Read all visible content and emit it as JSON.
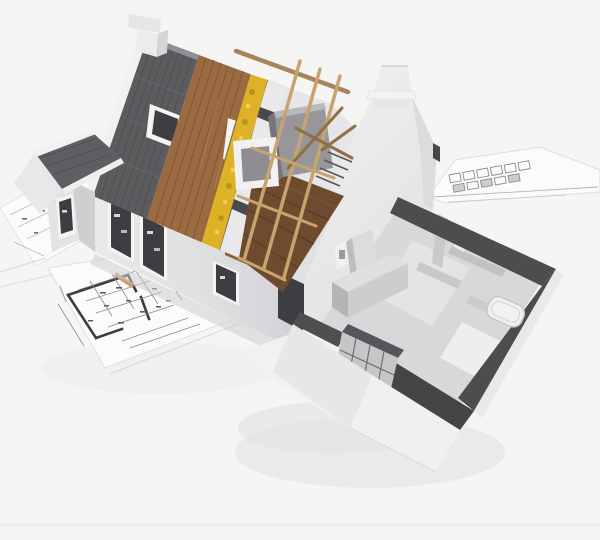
{
  "image_alt": "3D architectural rendering of a cutaway house model under construction, showing roof layers (shingles, wood sheathing, yellow insulation, white panels, exposed rafters), a white stepped gable wall, and a cutaway ground floor with rooms, sitting on architectural blueprint sheets",
  "palette": {
    "background": "#f5f5f4",
    "background_edge": "#ebebea",
    "shadow_soft": "#e9e9ea",
    "paper": "#fbfbfc",
    "paper_edge": "#dcdcdf",
    "paper_line": "#b9b9bf",
    "plan_line_dark": "#3c3c42",
    "plan_line_mid": "#8a8a90",
    "shingle": "#5c5c5f",
    "shingle_line": "#494950",
    "shingle_light": "#8f8f93",
    "rake_white": "#f1f1f2",
    "wood": "#9a6a40",
    "wood_line": "#7a5230",
    "wood_light": "#b48056",
    "insulation": "#ddb227",
    "insulation_dark": "#b8911c",
    "insulation_light": "#f0d054",
    "panel_white": "#e9e9eb",
    "panel_gap": "#4a4a4e",
    "rafter": "#c7a36e",
    "rafter_dark": "#8f6f46",
    "attic_wall": "#e6e6e8",
    "attic_floor": "#6e4a2f",
    "attic_floor_line": "#583823",
    "wall_white": "#ededee",
    "wall_shade": "#dcdcde",
    "facade_light": "#e8e8ea",
    "facade_dark": "#d2d2d5",
    "window_dark": "#3d3d42",
    "frame_white": "#f4f4f5",
    "eave_wood": "#8a5f3a",
    "cut_top": "#4d4d50",
    "interior_wall": "#c9c9cc",
    "floor_gray": "#d8d8da",
    "floor_light": "#e4e4e6",
    "bath_floor": "#eeeeef",
    "block_wall": "#c6c6c9",
    "block_line": "#6f6f74",
    "tub_white": "#f1f1f2",
    "tub_rim": "#c8c8cb",
    "wing_roof": "#5e5f62",
    "stick_wood": "#c49a67",
    "shadow_band": "#cdcdd0"
  },
  "scene": {
    "subject": "cutaway house construction model",
    "surface": "architectural blueprint sheets",
    "roof_layers": [
      "shingles",
      "wood sheathing",
      "mineral insulation",
      "white sarking panels",
      "open rafters"
    ],
    "interior": [
      "attic with furnace and window frame",
      "ground floor rooms",
      "block wall",
      "bathtub",
      "kitchen units"
    ]
  }
}
